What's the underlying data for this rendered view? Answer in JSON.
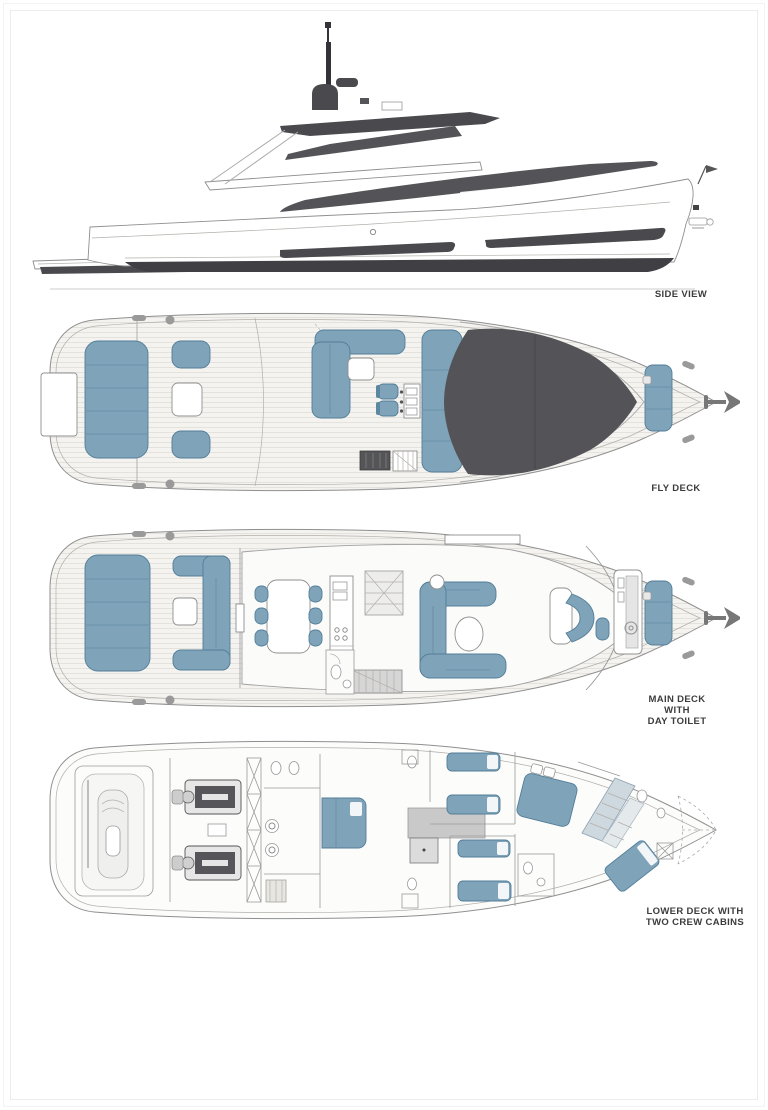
{
  "page": {
    "background": "#ffffff"
  },
  "colors": {
    "furniture_blue": "#7fa3b8",
    "furniture_line": "#537e99",
    "dark_glass": "#545458",
    "hull_dark": "#3f3f44",
    "line": "#8f8f8f",
    "label": "#3c3c3c"
  },
  "icons": {
    "bow_marker": "anchor-icon"
  },
  "labels": {
    "side_view": "SIDE VIEW",
    "fly_deck": "FLY DECK",
    "main_deck_1": "MAIN DECK",
    "main_deck_2": "WITH",
    "main_deck_3": "DAY TOILET",
    "lower_deck_1": "LOWER DECK WITH",
    "lower_deck_2": "TWO CREW CABINS"
  }
}
